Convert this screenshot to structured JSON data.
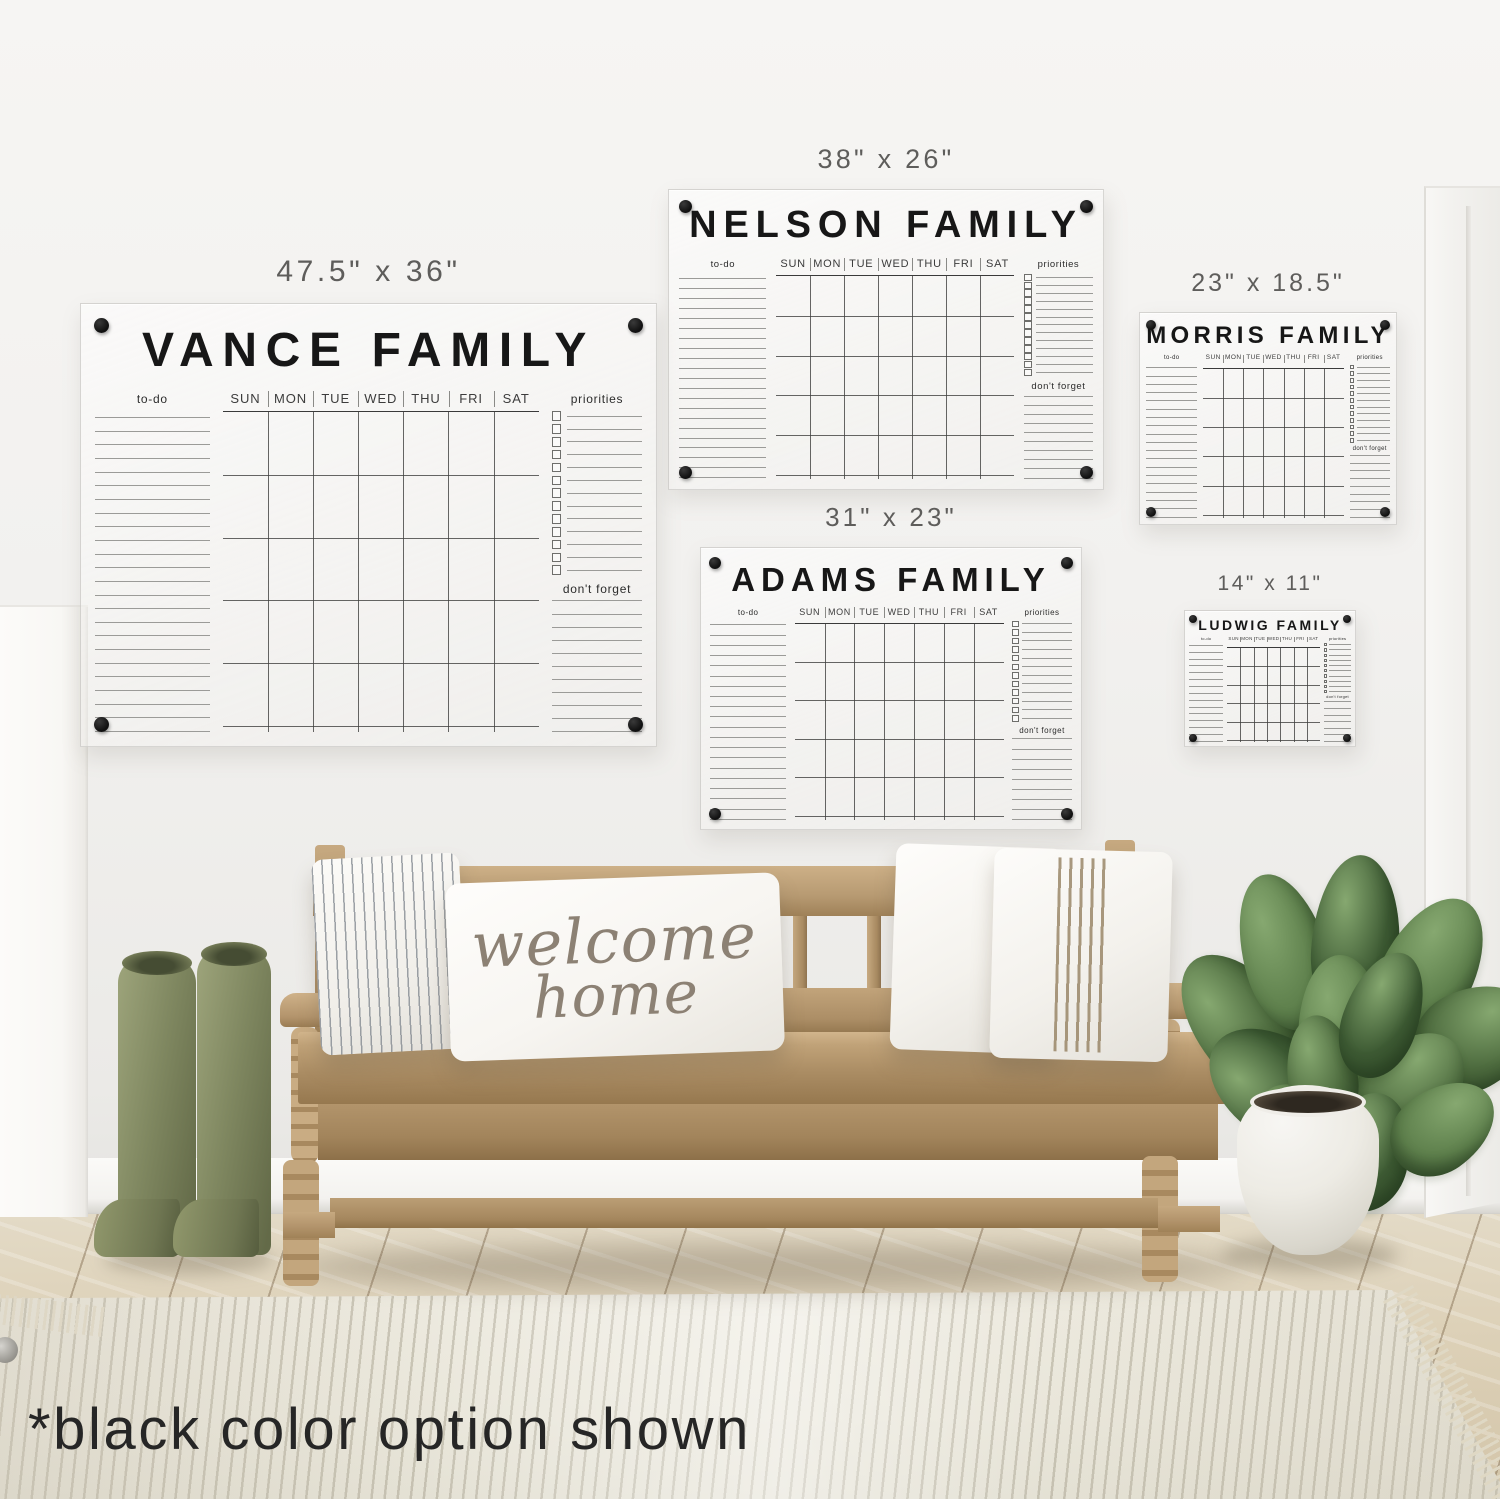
{
  "scene": {
    "footnote": "*black color option shown"
  },
  "pillow": {
    "line1": "welcome",
    "line2": "home"
  },
  "calendar_common": {
    "todo_label": "to-do",
    "priorities_label": "priorities",
    "dont_forget_label": "don't forget",
    "days": [
      "SUN",
      "MON",
      "TUE",
      "WED",
      "THU",
      "FRI",
      "SAT"
    ],
    "accent_color": "#1a1a1a"
  },
  "calendars": [
    {
      "id": "vance",
      "size_label": "47.5\" x 36\"",
      "title": "VANCE FAMILY"
    },
    {
      "id": "nelson",
      "size_label": "38\" x 26\"",
      "title": "NELSON FAMILY"
    },
    {
      "id": "morris",
      "size_label": "23\" x 18.5\"",
      "title": "MORRIS FAMILY"
    },
    {
      "id": "adams",
      "size_label": "31\" x 23\"",
      "title": "ADAMS FAMILY"
    },
    {
      "id": "ludwig",
      "size_label": "14\" x 11\"",
      "title": "LUDWIG FAMILY"
    }
  ],
  "palette": {
    "wall": "#f2f1ef",
    "floor_wood": "#ddd1b8",
    "bench_wood": "#b3946c",
    "boots_green": "#7f8760",
    "plant_green": "#50703f",
    "pot_white": "#edebe4",
    "rug_cream": "#ebe8dd",
    "calendar_accent": "#1a1a1a"
  }
}
